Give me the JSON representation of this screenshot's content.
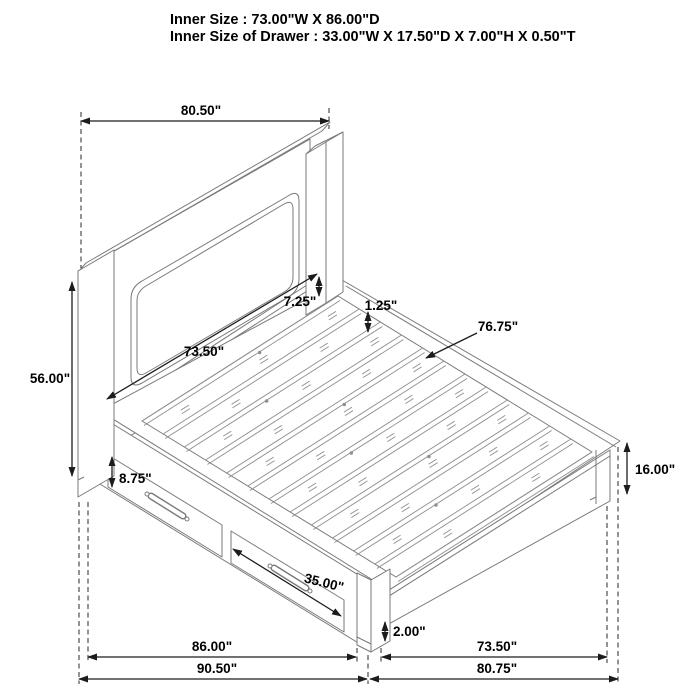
{
  "header": {
    "line1": "Inner Size : 73.00\"W X 86.00\"D",
    "line2": "Inner Size of Drawer : 33.00\"W X 17.50\"D X 7.00\"H X 0.50\"T"
  },
  "dims": {
    "headboard_width": "80.50\"",
    "headboard_height": "56.00\"",
    "headboard_panel_width": "73.50\"",
    "panel_to_rail_gap": "7.25\"",
    "slat_thickness": "1.25\"",
    "slat_length": "76.75\"",
    "drawer_face_height": "8.75\"",
    "drawer_width": "35.00\"",
    "footboard_height": "16.00\"",
    "foot_clearance": "2.00\"",
    "side_inner_length": "86.00\"",
    "side_overall_length": "90.50\"",
    "foot_inner_width": "73.50\"",
    "foot_overall_width": "80.75\""
  },
  "colors": {
    "background": "#ffffff",
    "bed_line": "#7a7a7a",
    "dimension_line": "#1c1c1c",
    "label_text": "#000000"
  }
}
